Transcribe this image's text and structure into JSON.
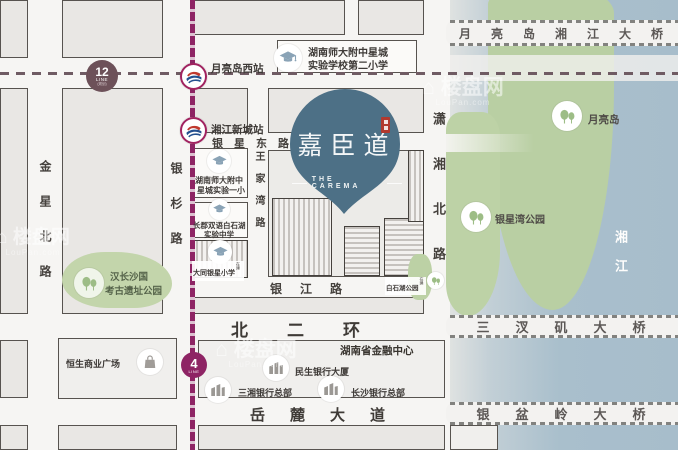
{
  "project": {
    "name": "嘉臣道",
    "name_en": "THE CAREMA"
  },
  "metro": {
    "line12": {
      "number": "12",
      "unit": "LINE",
      "note": "(规划)"
    },
    "line4": {
      "number": "4",
      "unit": "LINE"
    },
    "station_yueliangdao_west": "月亮岛西站",
    "station_xiangjiang_newtown": "湘江新城站"
  },
  "roads": {
    "jinxing_north": "金星北路",
    "yinshan": "银杉路",
    "wangjiawan": "王家湾路",
    "xiaoxiang_north": "潇湘北路",
    "yinxing_east": "银星东路",
    "yinjiang": "银江路",
    "north_second_ring": "北二环",
    "yuelu_avenue": "岳麓大道"
  },
  "bridges": {
    "yueliangdao": "月亮岛湘江大桥",
    "sanchaji": "三汊矶大桥",
    "yinpenling": "银盆岭大桥"
  },
  "water": {
    "river": "湘江"
  },
  "parks": {
    "yueliang_island": "月亮岛",
    "yinxingwan": "银星湾公园",
    "han_changsha_line1": "汉长沙国",
    "han_changsha_line2": "考古遗址公园",
    "baishihu": "白石湖公园",
    "baishihu_note": "在建"
  },
  "schools": {
    "shida_no2_line1": "湖南师大附中星城",
    "shida_no2_line2": "实验学校第二小学",
    "shida_yixiao_line1": "湖南师大附中",
    "shida_yixiao_line2": "星城实验一小",
    "changjun_line1": "长郡双语白石湖",
    "changjun_line2": "实验中学",
    "datong": "大同银星小学",
    "datong_note": "在建"
  },
  "landmarks": {
    "hengsheng": "恒生商业广场",
    "financial_center": "湖南省金融中心",
    "minsheng": "民生银行大厦",
    "sanxiang": "三湘银行总部",
    "changsha_bank": "长沙银行总部"
  },
  "watermark": {
    "brand": "楼盘网",
    "domain": "LouPan.com"
  },
  "colors": {
    "metro_magenta": "#8E2464",
    "line12_plum": "#6D5159",
    "pin_blue": "#4D7086",
    "island_green": "#B9CFA3",
    "river_blue": "#A9BFCC",
    "seal_red": "#B2392E"
  }
}
